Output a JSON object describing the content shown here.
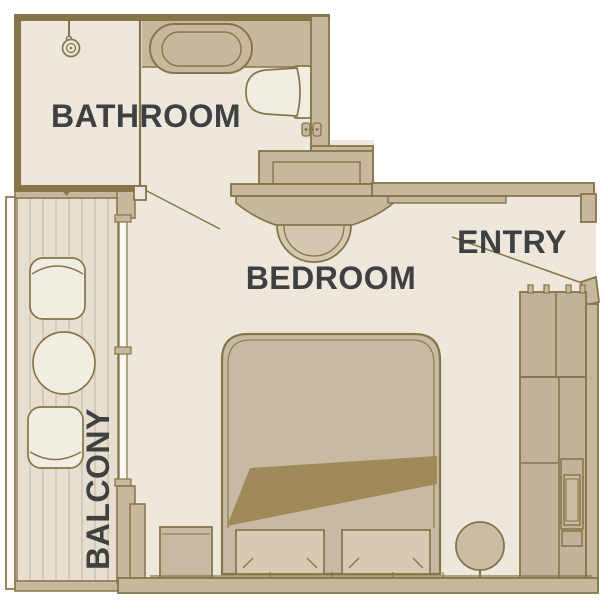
{
  "palette": {
    "background": "#FFFFFF",
    "outline": "#867549",
    "wall_fill": "#C7B79D",
    "floor": "#EDE7DC",
    "deck": "#E6DFD0",
    "deck_line": "#CBC0AA",
    "fixture_light": "#F1EDE3",
    "bed_tan": "#C7BAA3",
    "pillow_light": "#D6CAB2",
    "duvet_fold": "#A18A59",
    "closet_fill": "#C2B29A",
    "railing_light": "#FBF9F3",
    "label_text": "#3E4041"
  },
  "rooms": {
    "bathroom": {
      "label": "BATHROOM"
    },
    "bedroom": {
      "label": "BEDROOM"
    },
    "entry": {
      "label": "ENTRY"
    },
    "balcony": {
      "label": "BALCONY"
    }
  },
  "fixtures": [
    "shower",
    "bathtub",
    "toilet",
    "vanity-cabinet",
    "tv-shelf",
    "curved-counter",
    "stool",
    "double-bed",
    "duvet-fold",
    "pillows",
    "nightstand",
    "wardrobe",
    "safe",
    "pedestal-table",
    "balcony-chairs",
    "balcony-table",
    "balcony-railing",
    "sliding-window",
    "entry-door",
    "bathroom-door"
  ]
}
